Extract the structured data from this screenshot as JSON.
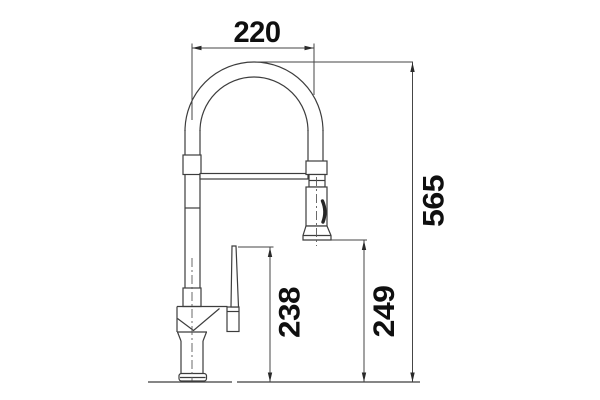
{
  "dimensions": {
    "spout_width": {
      "value": "220",
      "orientation": "horizontal"
    },
    "total_height": {
      "value": "565",
      "orientation": "vertical"
    },
    "handle_height": {
      "value": "238",
      "orientation": "vertical"
    },
    "spray_height": {
      "value": "249",
      "orientation": "vertical"
    }
  },
  "colors": {
    "line": "#3d3d3d",
    "text": "#0f0f0f",
    "background": "#ffffff"
  }
}
